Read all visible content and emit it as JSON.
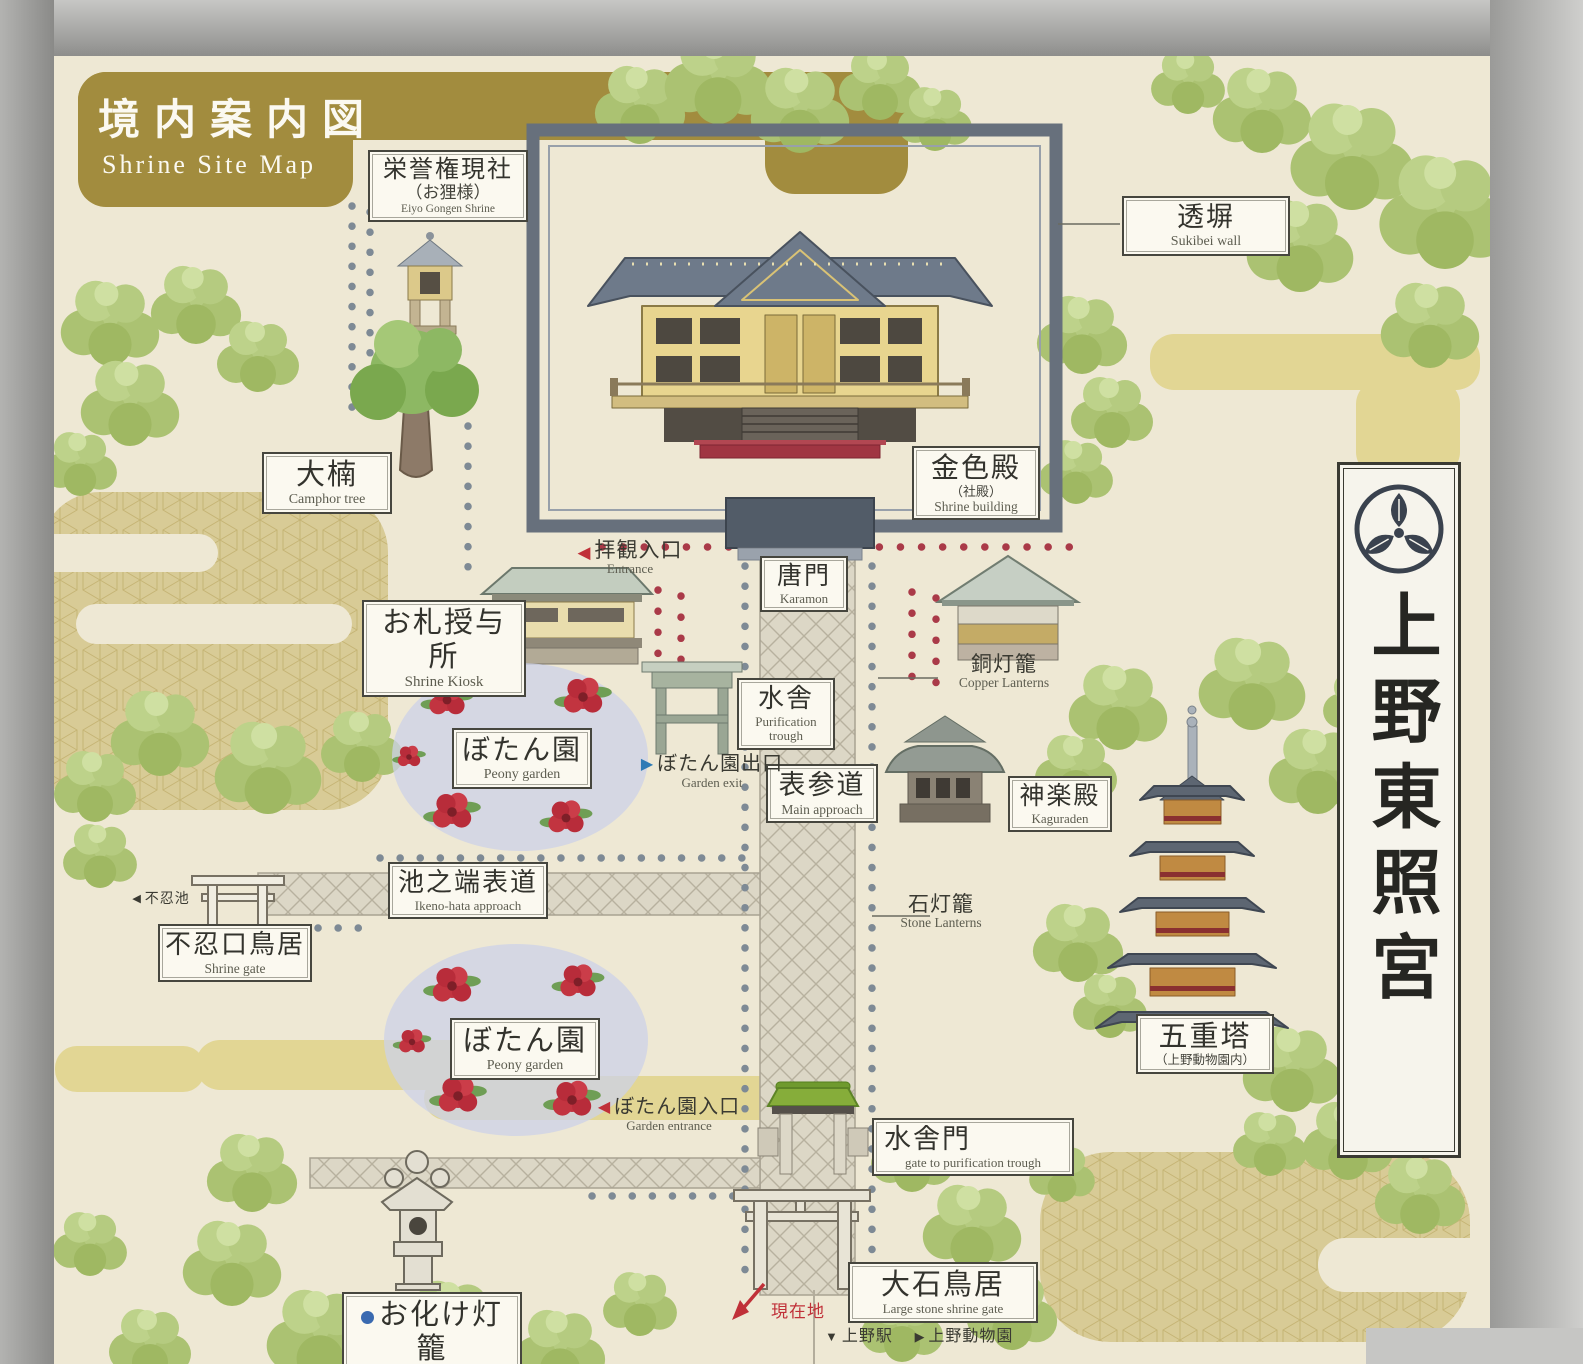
{
  "title": {
    "jp": "境内案内図",
    "en": "Shrine Site Map"
  },
  "side_banner": {
    "name": "上野東照宮"
  },
  "labels": {
    "eiyo_gongen": {
      "jp": "栄誉権現社",
      "sub": "（お狸様）",
      "en": "Eiyo Gongen Shrine"
    },
    "sukibei": {
      "jp": "透塀",
      "en": "Sukibei wall"
    },
    "camphor": {
      "jp": "大楠",
      "en": "Camphor tree"
    },
    "golden_hall": {
      "jp": "金色殿",
      "sub": "（社殿）",
      "en": "Shrine building"
    },
    "kiosk": {
      "jp": "お札授与所",
      "en": "Shrine Kiosk"
    },
    "karamon": {
      "jp": "唐門",
      "en": "Karamon"
    },
    "copper_lanterns": {
      "jp": "銅灯籠",
      "en": "Copper Lanterns"
    },
    "trough": {
      "jp": "水舎",
      "en": "Purification trough"
    },
    "main_approach": {
      "jp": "表参道",
      "en": "Main approach"
    },
    "peony1": {
      "jp": "ぼたん園",
      "en": "Peony garden"
    },
    "kaguraden": {
      "jp": "神楽殿",
      "en": "Kaguraden"
    },
    "ikenohata": {
      "jp": "池之端表道",
      "en": "Ikeno-hata approach"
    },
    "stone_lanterns": {
      "jp": "石灯籠",
      "en": "Stone Lanterns"
    },
    "shinobazu_torii": {
      "jp": "不忍口鳥居",
      "en": "Shrine gate"
    },
    "peony2": {
      "jp": "ぼたん園",
      "en": "Peony garden"
    },
    "pagoda": {
      "jp": "五重塔",
      "sub": "（上野動物園内）"
    },
    "suisha_gate": {
      "jp": "水舎門",
      "en": "gate to purification trough"
    },
    "obake": {
      "jp": "お化け灯籠",
      "en": "Obake-toro"
    },
    "oishi_torii": {
      "jp": "大石鳥居",
      "en": "Large stone shrine gate"
    }
  },
  "markers": {
    "entrance": {
      "arrow": "◀",
      "jp": "拝観入口",
      "en": "Entrance"
    },
    "garden_exit": {
      "arrow": "▶",
      "jp": "ぼたん園出口",
      "en": "Garden exit"
    },
    "garden_entrance": {
      "arrow": "◀",
      "jp": "ぼたん園入口",
      "en": "Garden entrance"
    },
    "shinobazu_pond": {
      "arrow": "◀",
      "jp": "不忍池"
    },
    "current_location": {
      "jp": "現在地"
    },
    "ueno_station": {
      "arrow": "▼",
      "jp": "上野駅"
    },
    "ueno_zoo": {
      "arrow": "▶",
      "jp": "上野動物園"
    }
  },
  "colors": {
    "gold_banner": "#a28c3e",
    "cream": "#eee8d4",
    "red_dots": "#aa3a48",
    "gray_dots": "#7e8a95",
    "wall": "#67707c",
    "accent_red": "#c03038",
    "marker_blue": "#2f7bb5"
  }
}
